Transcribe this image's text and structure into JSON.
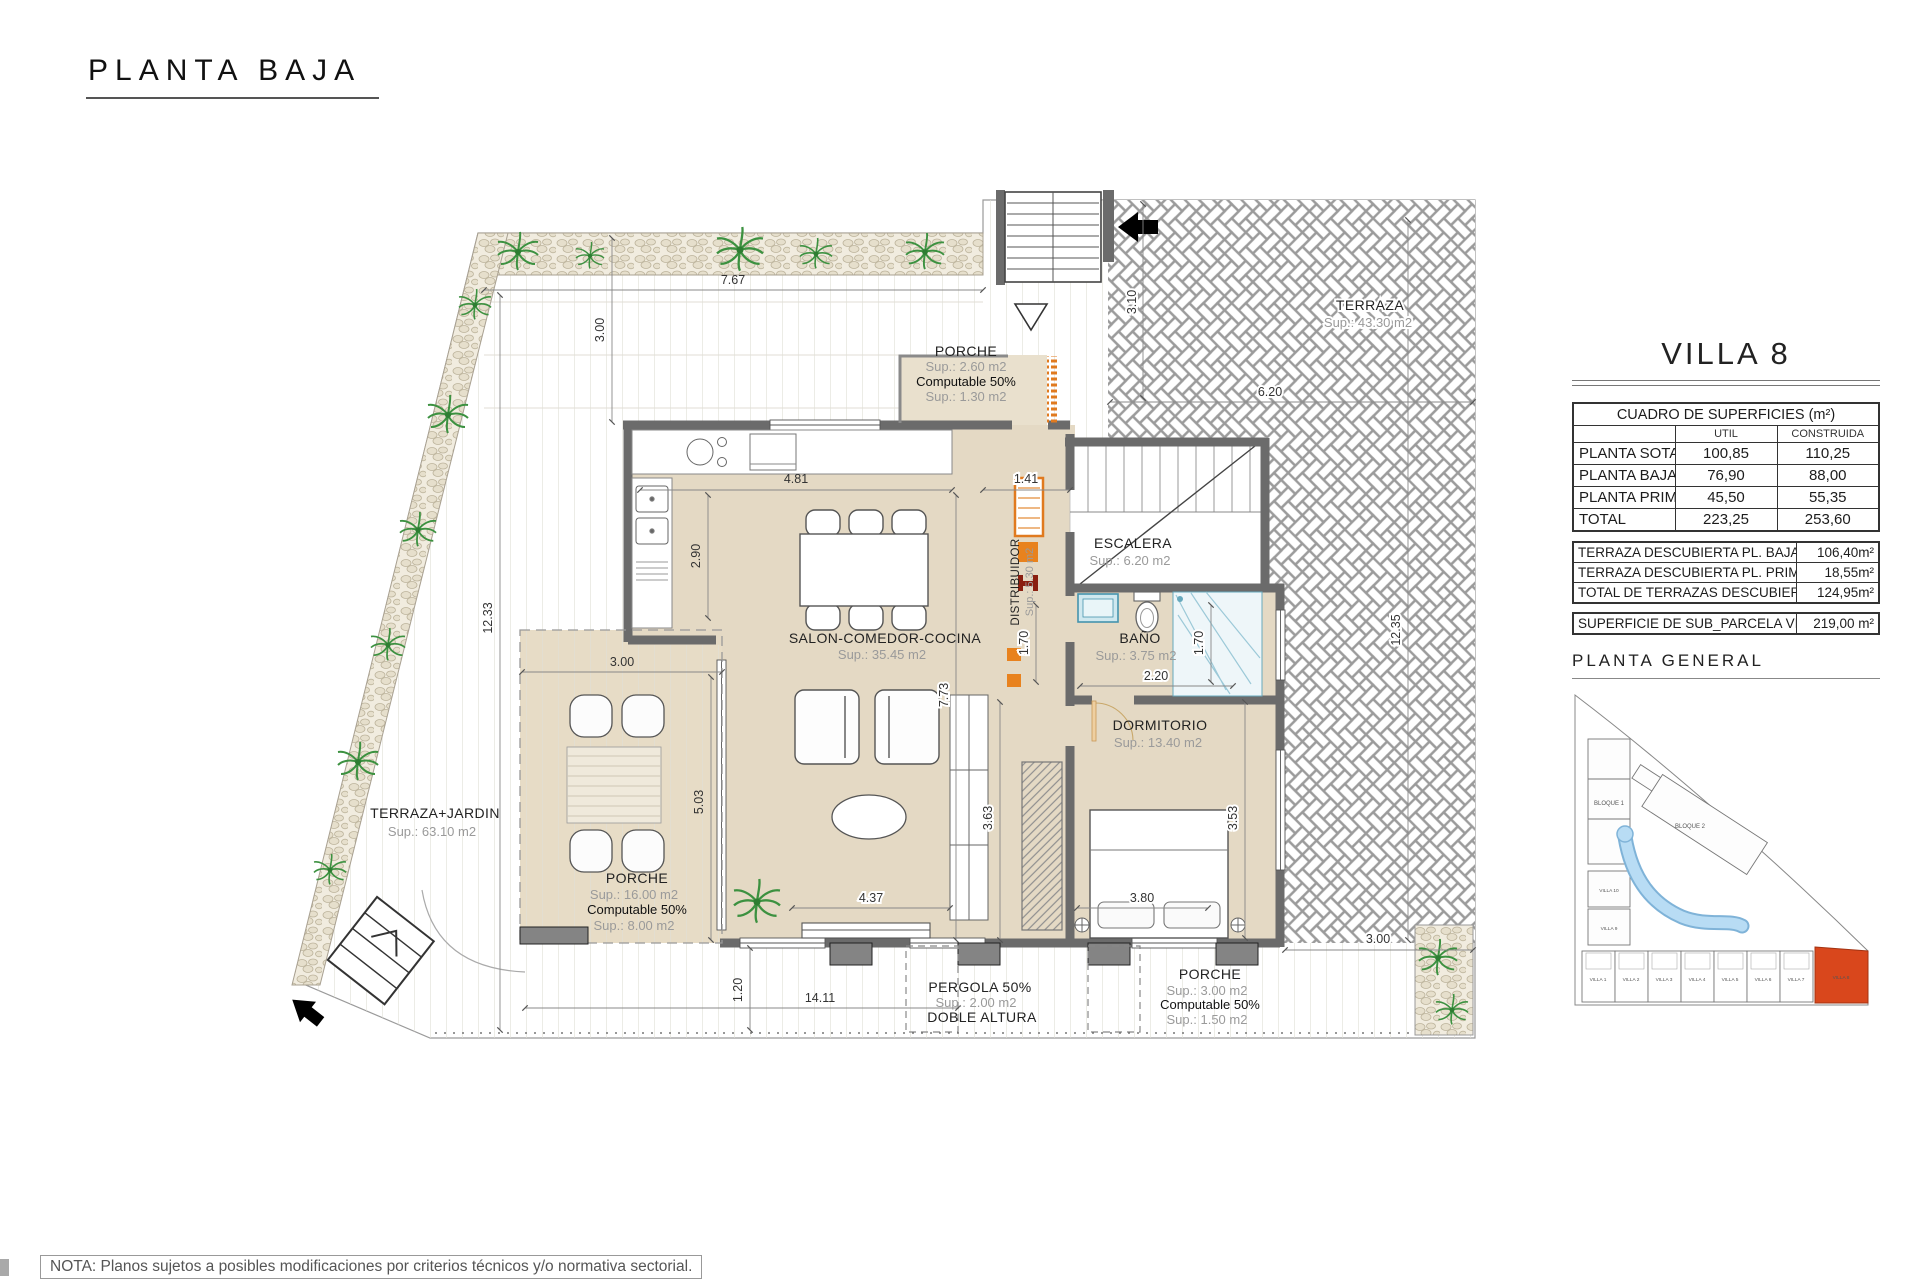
{
  "page": {
    "title": "PLANTA BAJA",
    "note": "NOTA: Planos sujetos a posibles modificaciones por criterios técnicos y/o normativa sectorial."
  },
  "panel": {
    "title": "VILLA 8",
    "surfaces": {
      "title": "CUADRO DE SUPERFICIES (m²)",
      "col_util": "UTIL",
      "col_constr": "CONSTRUIDA",
      "rows": [
        {
          "label": "PLANTA SOTANO",
          "util": "100,85",
          "constr": "110,25"
        },
        {
          "label": "PLANTA BAJA",
          "util": "76,90",
          "constr": "88,00"
        },
        {
          "label": "PLANTA PRIMERA",
          "util": "45,50",
          "constr": "55,35"
        },
        {
          "label": "TOTAL",
          "util": "223,25",
          "constr": "253,60"
        }
      ]
    },
    "terraces": {
      "rows": [
        {
          "label": "TERRAZA DESCUBIERTA PL. BAJA",
          "value": "106,40m²"
        },
        {
          "label": "TERRAZA DESCUBIERTA PL. PRIMERA",
          "value": "18,55m²"
        },
        {
          "label": "TOTAL DE TERRAZAS DESCUBIERTAS",
          "value": "124,95m²"
        }
      ]
    },
    "parcel": {
      "label": "SUPERFICIE DE SUB_PARCELA VILLA 8",
      "value": "219,00 m²"
    },
    "site_plan": {
      "title": "PLANTA GENERAL",
      "bloque1": "BLOQUE 1",
      "bloque2": "BLOQUE 2",
      "villa10": "VILLA 10",
      "villa9": "VILLA 9",
      "villas": [
        "VILLA 1",
        "VILLA 2",
        "VILLA 3",
        "VILLA 4",
        "VILLA 5",
        "VILLA 6",
        "VILLA 7"
      ],
      "villa8": "VILLA 8"
    }
  },
  "plan": {
    "rooms": {
      "porche_top": {
        "name": "PORCHE",
        "sup": "Sup.: 2.60 m2",
        "comp": "Computable 50%",
        "comp_sup": "Sup.: 1.30 m2"
      },
      "salon": {
        "name": "SALON-COMEDOR-COCINA",
        "sup": "Sup.: 35.45 m2"
      },
      "distribuidor": {
        "name": "DISTRIBUIDOR",
        "sup": "Sup.: 5.30 m2"
      },
      "escalera": {
        "name": "ESCALERA",
        "sup": "Sup.: 6.20 m2"
      },
      "bano": {
        "name": "BAÑO",
        "sup": "Sup.: 3.75 m2"
      },
      "dormitorio": {
        "name": "DORMITORIO",
        "sup": "Sup.: 13.40 m2"
      },
      "terraza_jardin": {
        "name": "TERRAZA+JARDIN",
        "sup": "Sup.: 63.10 m2"
      },
      "porche_left": {
        "name": "PORCHE",
        "sup": "Sup.: 16.00 m2",
        "comp": "Computable 50%",
        "comp_sup": "Sup.: 8.00 m2"
      },
      "pergola": {
        "name": "PERGOLA 50%",
        "sup": "Sup.: 2.00 m2",
        "extra": "DOBLE ALTURA"
      },
      "porche_right": {
        "name": "PORCHE",
        "sup": "Sup.: 3.00 m2",
        "comp": "Computable 50%",
        "comp_sup": "Sup.: 1.50 m2"
      },
      "terraza": {
        "name": "TERRAZA",
        "sup": "Sup.: 43.30 m2"
      }
    },
    "dims": {
      "top_w": "7.67",
      "top_h": "3.00",
      "left_h": "12.33",
      "right_h": "12.35",
      "stairs_h": "3.10",
      "terraza_w": "6.20",
      "kitchen_w": "4.81",
      "kitchen_h": "2.90",
      "hall_w": "1.41",
      "porch_w": "3.00",
      "porch_h": "5.03",
      "salon_h": "7.73",
      "bath_h1": "1.70",
      "bath_h2": "1.70",
      "bath_w": "2.20",
      "salon_h2": "3.63",
      "dorm_h": "3.53",
      "salon_w": "4.37",
      "dorm_w": "3.80",
      "plot_w": "14.11",
      "plot_h": "1.20",
      "walk_w": "3.00"
    }
  },
  "colors": {
    "wall": "#6b6b6b",
    "floor": "#e4d9c4",
    "accent_orange": "#e07a1f",
    "villa8_highlight": "#d9471c",
    "pool": "#a9d3ee"
  }
}
